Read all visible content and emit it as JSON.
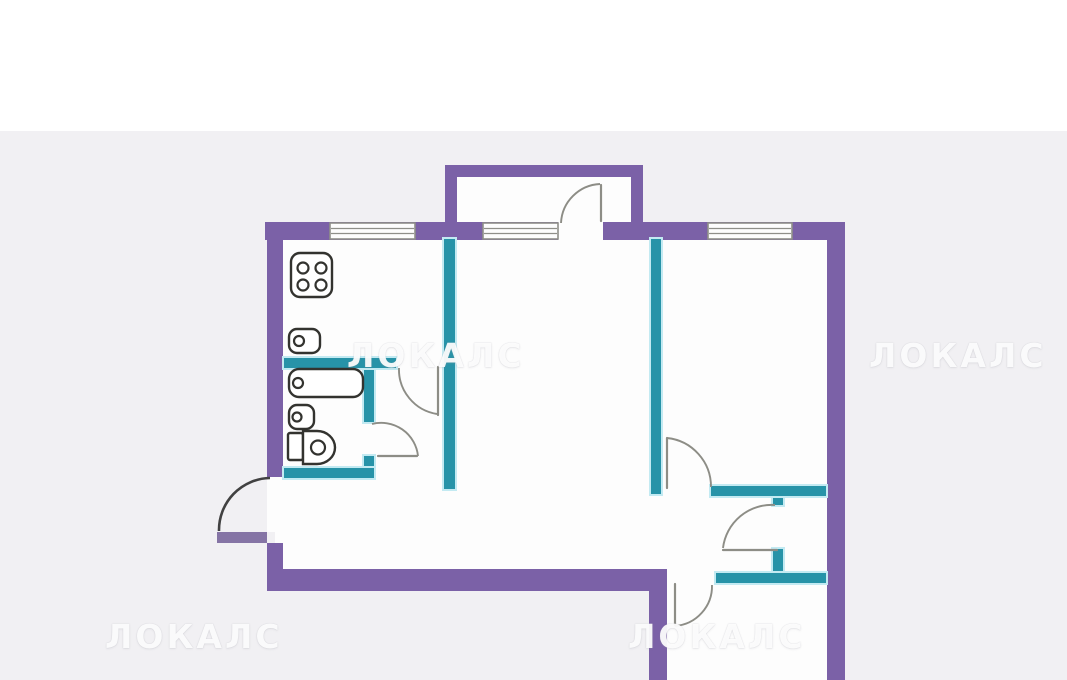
{
  "watermark": {
    "text": "ЛОКАЛС",
    "count": 4
  },
  "colors": {
    "bg": "#f1f0f3",
    "bg_top": "#ffffff",
    "floor": "#fdfdfd",
    "wall_outer": "#7b61a7",
    "wall_inner": "#2793a8",
    "wall_glow": "#c3eaf2",
    "door_leaf_purple": "#8574a5",
    "window_frame": "#8f8f89",
    "door_line": "#8d8d86",
    "door_line_dark": "#414141",
    "fixture_line": "#33332f"
  },
  "icons": [
    "stove-icon",
    "kitchen-sink-icon",
    "bathtub-icon",
    "washbasin-icon",
    "toilet-icon",
    "window-icon",
    "door-swing-icon"
  ]
}
